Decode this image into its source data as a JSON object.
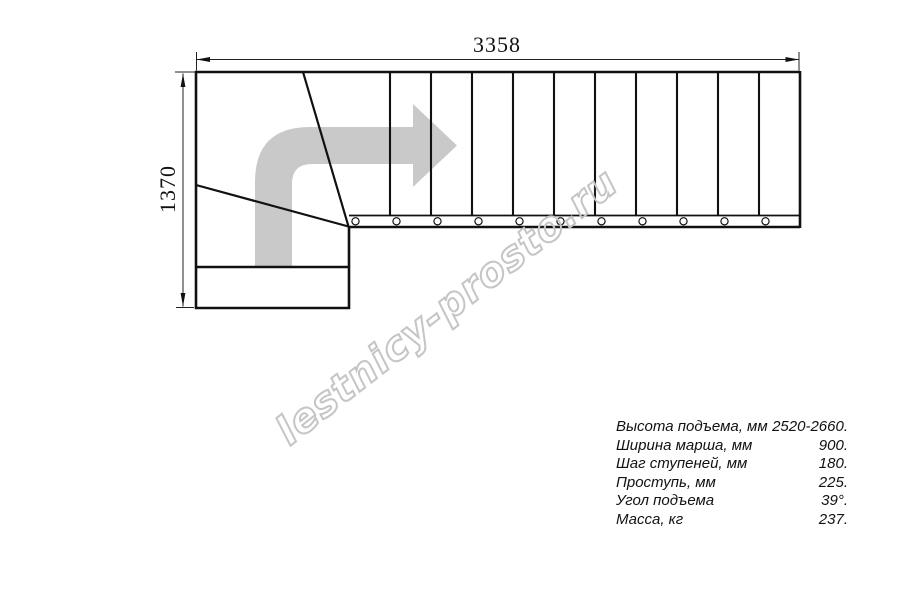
{
  "drawing": {
    "type": "staircase-plan-top-view",
    "dimensions": {
      "width_mm": "3358",
      "height_mm": "1370"
    },
    "tread_count_straight_run": 11,
    "baluster_count": 11,
    "direction_arrow": "turn-right-arrow"
  },
  "watermark": {
    "text": "lestnicy-prosto.ru"
  },
  "specs": {
    "rows": [
      {
        "label": "Высота подъема, мм",
        "value": "2520-2660."
      },
      {
        "label": "Ширина марша, мм",
        "value": "900."
      },
      {
        "label": "Шаг ступеней, мм",
        "value": "180."
      },
      {
        "label": "Проступь, мм",
        "value": "225."
      },
      {
        "label": "Угол подъема",
        "value": "39°."
      },
      {
        "label": "Масса, кг",
        "value": "237."
      }
    ]
  },
  "colors": {
    "line": "#111111",
    "dimension_line": "#222222",
    "direction_arrow_fill": "#c9c9c9",
    "watermark_stroke": "#c5c5c5",
    "background": "#ffffff"
  }
}
